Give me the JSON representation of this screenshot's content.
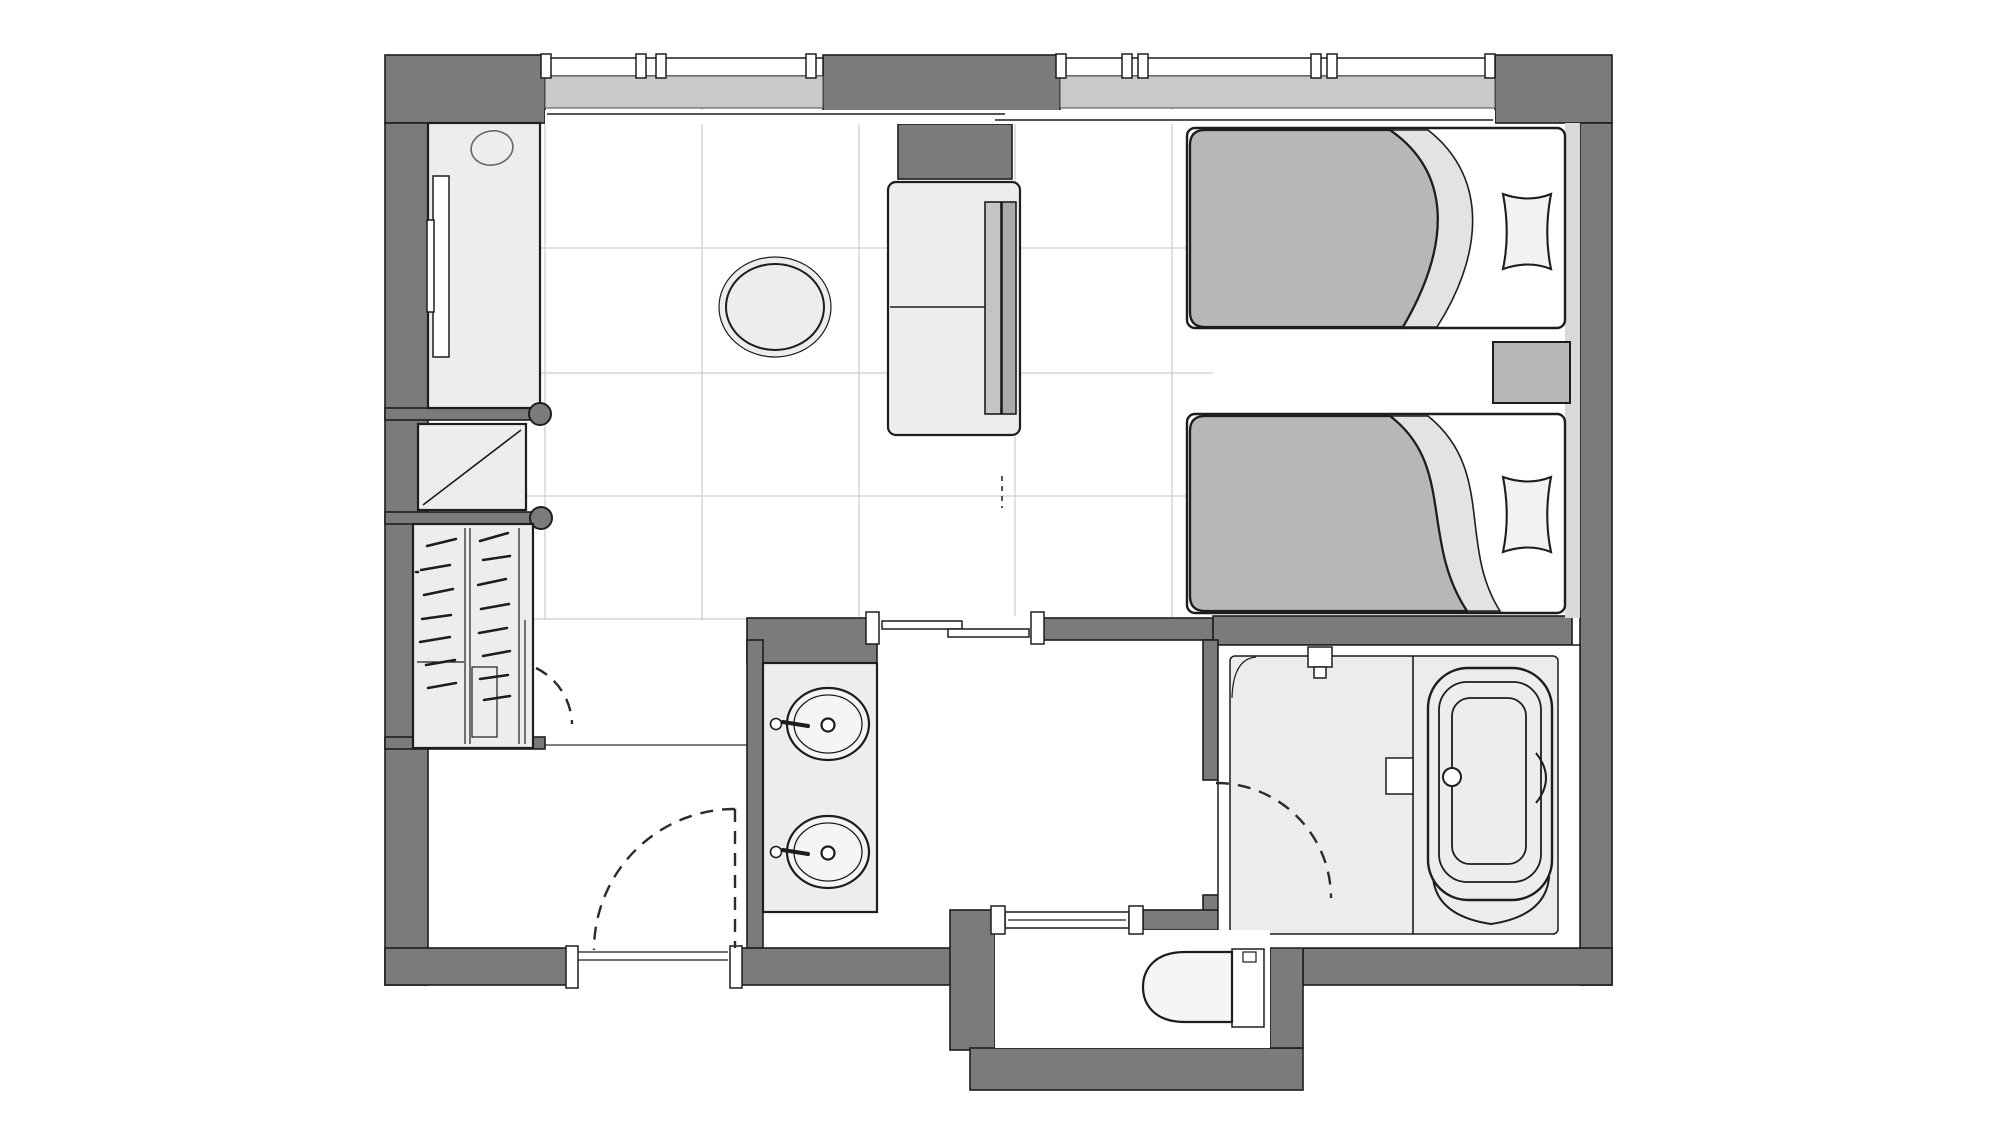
{
  "meta": {
    "title": "Hotel twin-room architectural floor plan",
    "description": "Top-down monochrome floor plan drawing with no text labels",
    "view": "top-down",
    "labels_visible": false
  },
  "colors": {
    "wall": "#7b7b7b",
    "outline": "#1d1d1d",
    "floor": "#ffffff",
    "tile": "#cccccc",
    "light": "#ededed",
    "lighter": "#f5f5f5",
    "duvet": "#b7b7b7",
    "sheet": "#e3e3e3",
    "pillow": "#f2f2f2",
    "glass": "#c9c9c9",
    "bath": "#ececec",
    "headboard": "#d9d9d9",
    "sofa_back_a": "#c4c4c4",
    "sofa_back_b": "#aaaaaa",
    "dash": "#2b2b2b",
    "boundary": "#555555"
  },
  "rooms": [
    {
      "id": "main-room",
      "kind": "combined living / twin bedroom",
      "floor": "tile grid + plain"
    },
    {
      "id": "entry",
      "kind": "entrance corridor",
      "floor": "plain"
    },
    {
      "id": "vanity-area",
      "kind": "washroom with double basin",
      "floor": "plain"
    },
    {
      "id": "bathroom",
      "kind": "unit bath with tub and shower",
      "floor": "light gray"
    },
    {
      "id": "toilet-room",
      "kind": "separate WC",
      "floor": "plain"
    }
  ],
  "fixtures": [
    "window-left",
    "window-right",
    "desk-cabinet",
    "wall-tv",
    "desk-accessory-circle",
    "luggage-rack",
    "wardrobe-with-hangers",
    "round-table",
    "sofa",
    "twin-bed-1",
    "twin-bed-2",
    "pillow-1",
    "pillow-2",
    "nightstand",
    "vanity-counter",
    "washbasin-1",
    "washbasin-2",
    "bathtub",
    "shower-head",
    "bath-shelf",
    "toilet",
    "entrance-door-swing",
    "closet-door-swing",
    "bathroom-door-swing",
    "sliding-door-main",
    "sliding-door-toilet"
  ],
  "counts": {
    "windows": 2,
    "beds": 2,
    "washbasins": 2,
    "hinged_doors": 3,
    "sliding_doors": 2
  }
}
